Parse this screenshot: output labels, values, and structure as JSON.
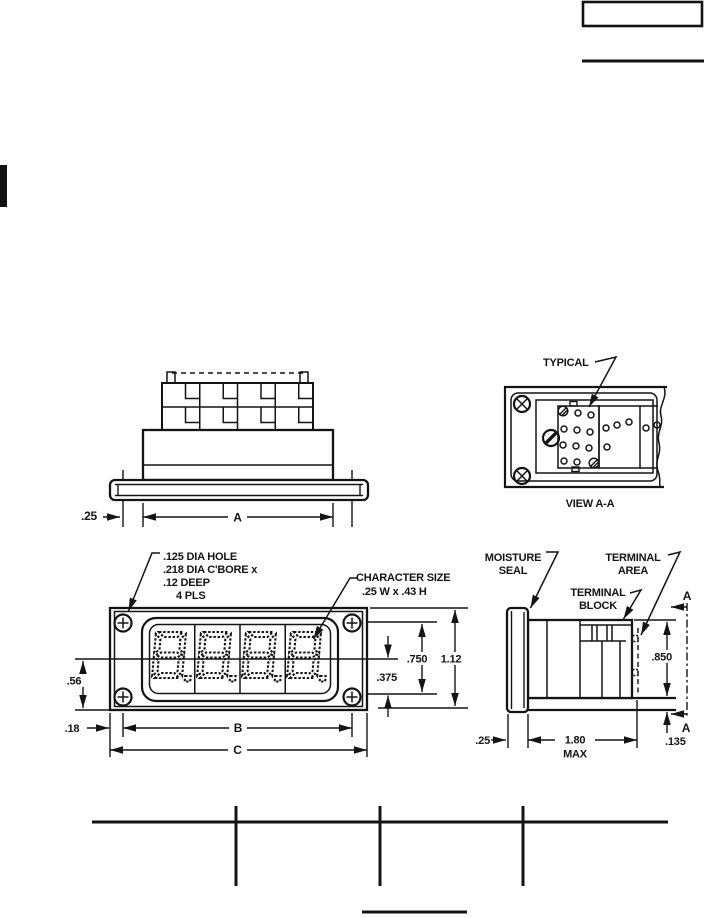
{
  "drawing": {
    "top_view": {
      "dim_bezel_lip": ".25",
      "dim_body_width": "A"
    },
    "view_aa": {
      "typical_label": "TYPICAL",
      "view_title": "VIEW A-A"
    },
    "front_view": {
      "hole_callout": [
        ".125 DIA HOLE",
        ".218 DIA C'BORE x",
        ".12 DEEP",
        "4 PLS"
      ],
      "character_size_callout": [
        "CHARACTER SIZE",
        ".25 W x .43 H"
      ],
      "dim_half_window": ".375",
      "dim_window_height": ".750",
      "dim_bezel_height": "1.12",
      "dim_center_to_bottom": ".56",
      "dim_edge_to_hole": ".18",
      "dim_hole_spacing": "B",
      "dim_overall_width": "C"
    },
    "side_view": {
      "moisture_seal_label": [
        "MOISTURE",
        "SEAL"
      ],
      "terminal_area_label": [
        "TERMINAL",
        "AREA"
      ],
      "terminal_block_label": [
        "TERMINAL",
        "BLOCK"
      ],
      "section_marker_top": "A",
      "section_marker_bottom": "A",
      "dim_cutout_height": ".850",
      "dim_depth": "1.80",
      "dim_depth_qualifier": "MAX",
      "dim_bezel_thickness": ".25",
      "dim_panel_thickness": ".135"
    }
  },
  "colors": {
    "ink": "#141414",
    "paper": "#ffffff"
  }
}
